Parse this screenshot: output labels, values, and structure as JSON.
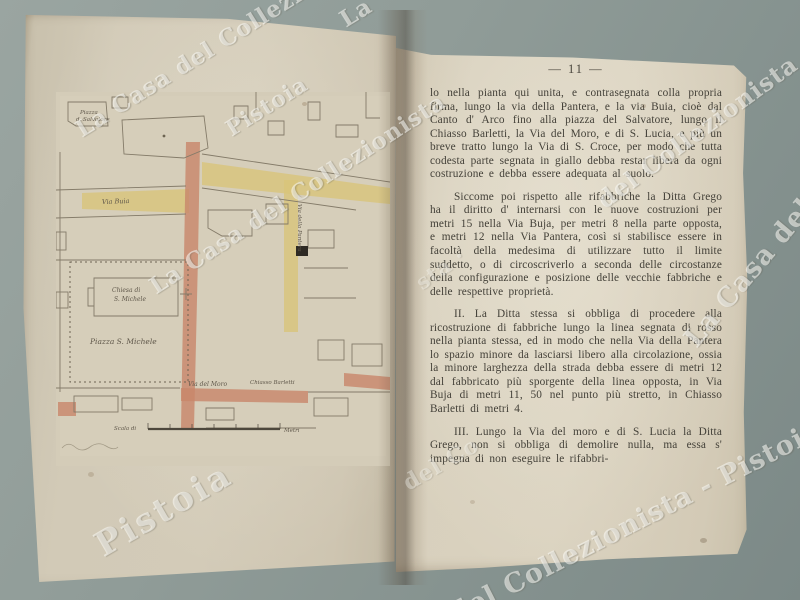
{
  "photo": {
    "background_color": "#84918e",
    "paper_color": "#d5cdb9"
  },
  "watermark": {
    "text": "La Casa del Collezionista - Pistoia",
    "color": "#ffffff",
    "fragments": [
      {
        "text": "La Casa del Collezionista"
      },
      {
        "text": "Pistoia"
      },
      {
        "text": "La"
      },
      {
        "text": "La Casa del Collezionista"
      },
      {
        "text": "del Collezionista"
      },
      {
        "text": "La Casa del"
      },
      {
        "text": "del Collezionista - Pistoia"
      },
      {
        "text": "Pistoia"
      },
      {
        "text": "del Co"
      },
      {
        "text": "sta ·"
      }
    ]
  },
  "left_page": {
    "map": {
      "labels": {
        "piazza_salvatore_1": "Piazza",
        "piazza_salvatore_2": "d. Salvatore",
        "via_buia": "Via Buia",
        "via_pantera": "Via della Pantera",
        "chiesa_1": "Chiesa di",
        "chiesa_2": "S. Michele",
        "piazza_michele": "Piazza S. Michele",
        "via_moro": "Via del Moro",
        "chiasso_barletti": "Chiasso Barletti",
        "scala": "Scala di",
        "metri": "Metri"
      },
      "colors": {
        "demolition_yellow": "#d9c478",
        "rebuild_red": "#c8866a"
      }
    }
  },
  "right_page": {
    "page_number": "— 11 —",
    "paragraphs": [
      "lo nella pianta qui unita, e contrasegnata colla propria firma, lungo la via della Pantera, e la via Buia, cioè dal Canto d' Arco fino alla piazza del Salvatore, lungo il Chiasso Barletti, la Via del Moro, e di S. Lucia, e più un breve tratto lungo la Via di S. Croce, per modo che tutta codesta parte segnata in giallo debba restar libera da ogni costruzione e debba essere adequata al suolo.",
      "Siccome poi rispetto alle rifabbriche la Ditta Grego ha il diritto d' internarsi con le nuove costruzioni per metri 15 nella Via Buja, per metri 8 nella parte opposta, e metri 12 nella Via Pantera, così si stabilisce essere in facoltà della medesima di utilizzare tutto il limite suddetto, o di circoscriverlo a seconda delle circostanze della configurazione e posizione delle vecchie fabbriche e delle respettive proprietà.",
      "II. La Ditta stessa si obbliga di procedere alla ricostruzione di fabbriche lungo la linea segnata di rosso nella pianta stessa, ed in modo che nella Via della Pantera lo spazio minore da lasciarsi libero alla circolazione, ossia la minore larghezza della strada debba essere di metri 12 dal fabbricato più sporgente della linea opposta, in Via Buja di metri 11, 50 nel punto più stretto, in Chiasso Barletti di metri 4.",
      "III. Lungo la Via del moro e di S. Lucia la Ditta Grego, non si obbliga di demolire nulla, ma essa s' impegna di non eseguire le rifabbri-"
    ]
  }
}
